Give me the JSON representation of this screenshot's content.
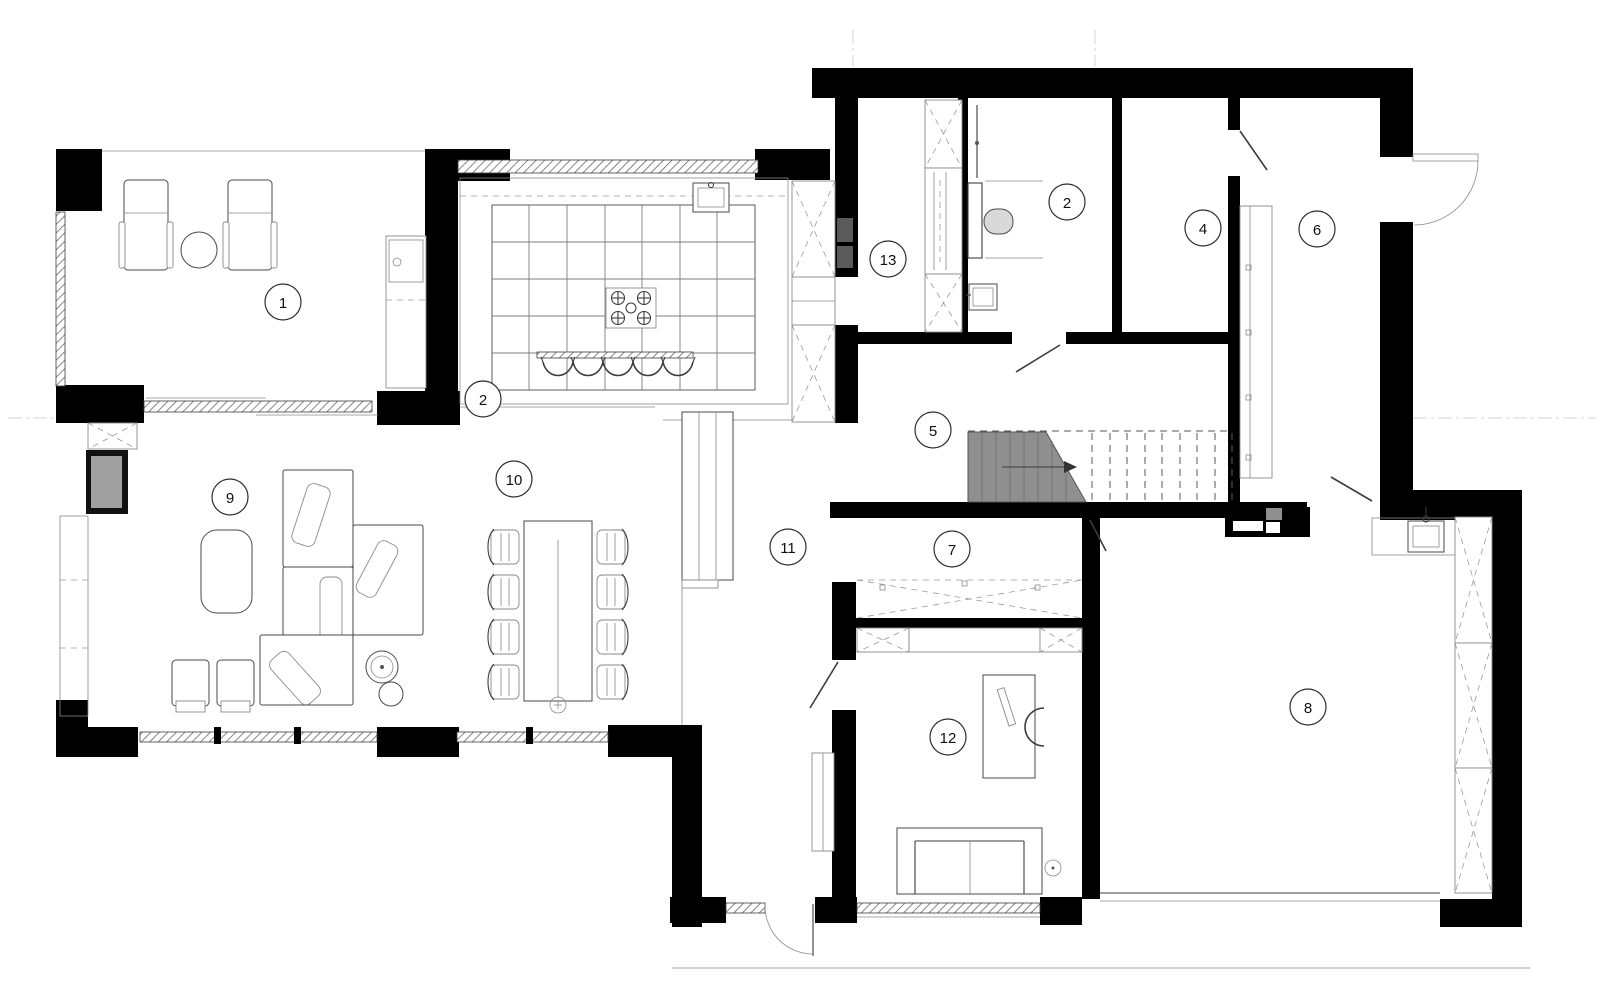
{
  "floor_plan": {
    "markers": [
      {
        "label": "1"
      },
      {
        "label": "2"
      },
      {
        "label": "2"
      },
      {
        "label": "4"
      },
      {
        "label": "5"
      },
      {
        "label": "6"
      },
      {
        "label": "7"
      },
      {
        "label": "8"
      },
      {
        "label": "9"
      },
      {
        "label": "10"
      },
      {
        "label": "11"
      },
      {
        "label": "12"
      },
      {
        "label": "13"
      }
    ],
    "colors": {
      "wall": "#000000",
      "stair_fill": "#8f8f8f",
      "appliance": "#5a5a5a",
      "fireplace": "#a0a0a0",
      "equipment": "#8f8f8f"
    }
  }
}
